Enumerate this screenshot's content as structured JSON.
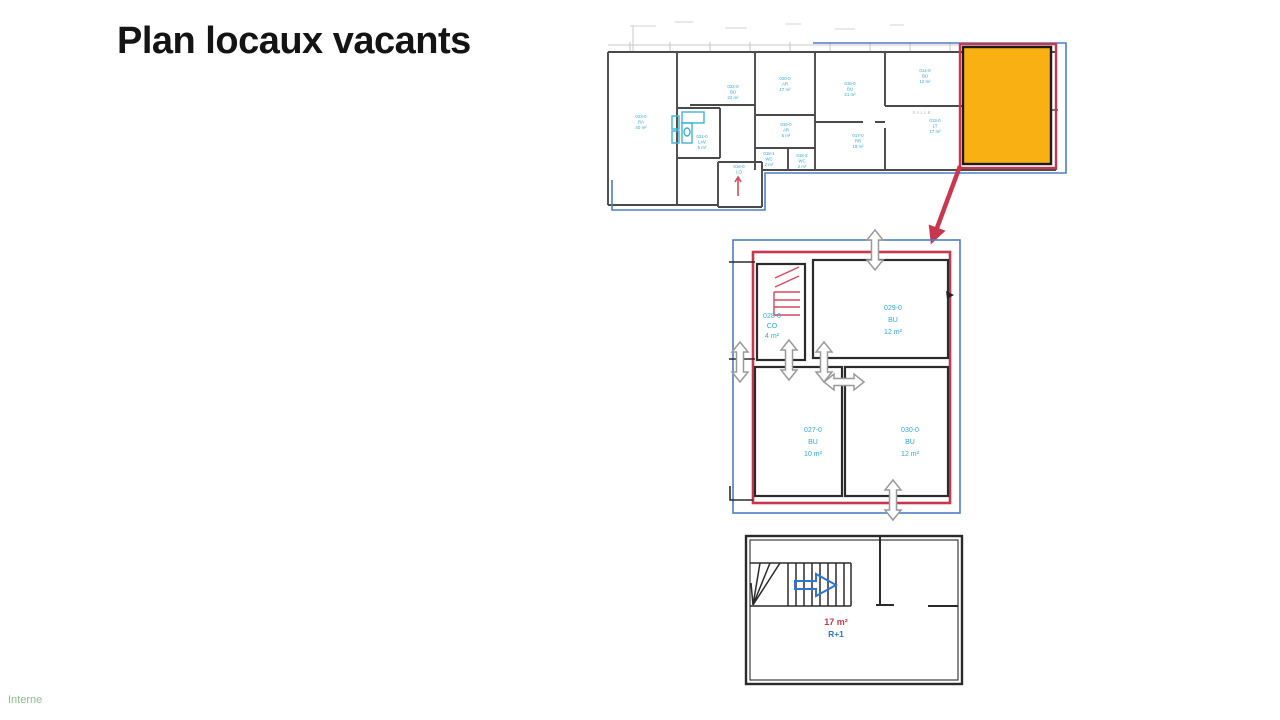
{
  "slide": {
    "title": "Plan locaux vacants",
    "footer": "Interne"
  },
  "colors": {
    "highlight_orange": "#F9B013",
    "highlight_red": "#C8374D",
    "stair_red": "#D6495E",
    "boundary_blue": "#4D7FC4",
    "label_cyan": "#2FA8D5",
    "stair_arrow_blue": "#2E75D6",
    "wall_gray": "#4A4A4A",
    "wall_dark": "#2B2B2B",
    "opening_arrow_gray": "#9A9A9A",
    "footer_green": "#8FBC8F"
  },
  "overview_plan": {
    "rooms": [
      {
        "id": "023-0",
        "code": "RA",
        "area": "40 m²"
      },
      {
        "id": "022-0",
        "code": "BU",
        "area": "22 m²"
      },
      {
        "id": "021-0",
        "code": "LAV",
        "area": "5 m²"
      },
      {
        "id": "020-0",
        "code": "AR",
        "area": "17 m²"
      },
      {
        "id": "015-0",
        "code": "BU",
        "area": "21 m²"
      },
      {
        "id": "014-0",
        "code": "BU",
        "area": "12 m²"
      },
      {
        "id": "019-0",
        "code": "AR",
        "area": "5 m²"
      },
      {
        "id": "018-1",
        "code": "WC",
        "area": "2 m²"
      },
      {
        "id": "018-2",
        "code": "WC",
        "area": "2 m²"
      },
      {
        "id": "017-0",
        "code": "RR",
        "area": "19 m²"
      },
      {
        "id": "013-0",
        "code": "LT",
        "area": "17 m²"
      },
      {
        "id": "016-0",
        "code": "LO",
        "area": "6 m²"
      }
    ],
    "faint_label": "SALLE"
  },
  "detail_plan": {
    "rooms": [
      {
        "id": "028-0",
        "code": "CO",
        "area": "4 m²"
      },
      {
        "id": "029-0",
        "code": "BU",
        "area": "12 m²"
      },
      {
        "id": "027-0",
        "code": "BU",
        "area": "10 m²"
      },
      {
        "id": "030-0",
        "code": "BU",
        "area": "12 m²"
      }
    ]
  },
  "stair_plan": {
    "area": "17 m²",
    "level": "R+1"
  }
}
